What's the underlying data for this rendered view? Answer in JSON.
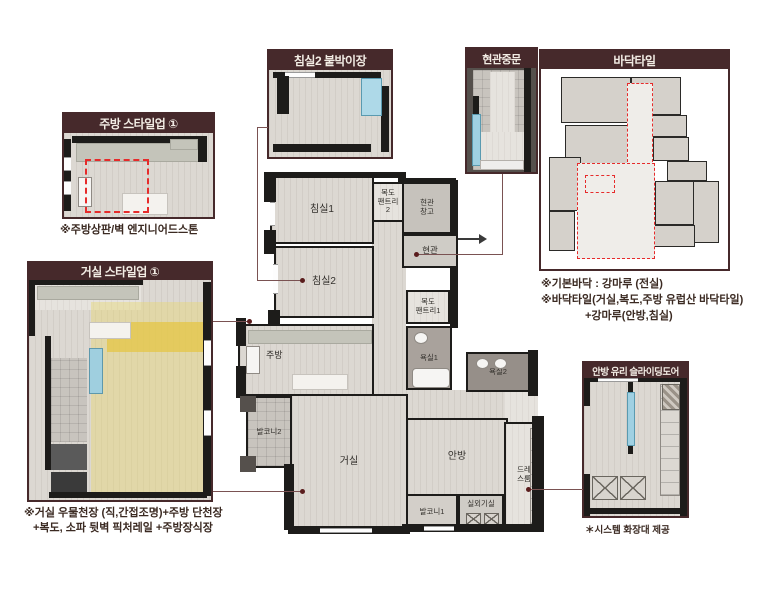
{
  "colors": {
    "header_bg": "#46292b",
    "header_text": "#f2ece4",
    "wall": "#1d1c1a",
    "floor": "#dcd8d2",
    "highlight_yellow": "#e8d671",
    "highlight_blue": "#a5d3e4",
    "dash_red": "#e62b2b",
    "leader_line": "#7a5252"
  },
  "callouts": {
    "kitchen_styleup": {
      "title": "주방 스타일업 ①",
      "caption": "※주방상판/벽 엔지니어드스톤"
    },
    "living_styleup": {
      "title": "거실 스타일업 ①",
      "caption1": "※거실 우물천장 (직,간접조명)+주방 단천장",
      "caption2": "+복도, 소파 뒷벽 픽처레일 +주방장식장"
    },
    "bedroom2_closet": {
      "title": "침실2 붙박이장"
    },
    "entrance_door": {
      "title": "현관중문"
    },
    "floor_tile": {
      "title": "바닥타일",
      "caption1": "※기본바닥 : 강마루 (전실)",
      "caption2": "※바닥타일(거실,복도,주방 유럽산 바닥타일)",
      "caption3": "+강마루(안방,침실)"
    },
    "master_sliding_door": {
      "title": "안방 유리 슬라이딩도어",
      "caption": "＊시스템 화장대 제공"
    }
  },
  "main_plan": {
    "rooms": {
      "bedroom1": "침실1",
      "pantry2": "복도\n팬트리\n2",
      "entry_storage": "현관\n창고",
      "entry": "현관",
      "bedroom2": "침실2",
      "pantry1": "복도\n팬트리1",
      "bath1": "욕실1",
      "kitchen": "주방",
      "balcony2": "발코니2",
      "living": "거실",
      "bath2": "욕실2",
      "master": "안방",
      "dress": "드레\n스룸",
      "balcony1": "발코니1",
      "ac_room": "실외기실"
    }
  }
}
